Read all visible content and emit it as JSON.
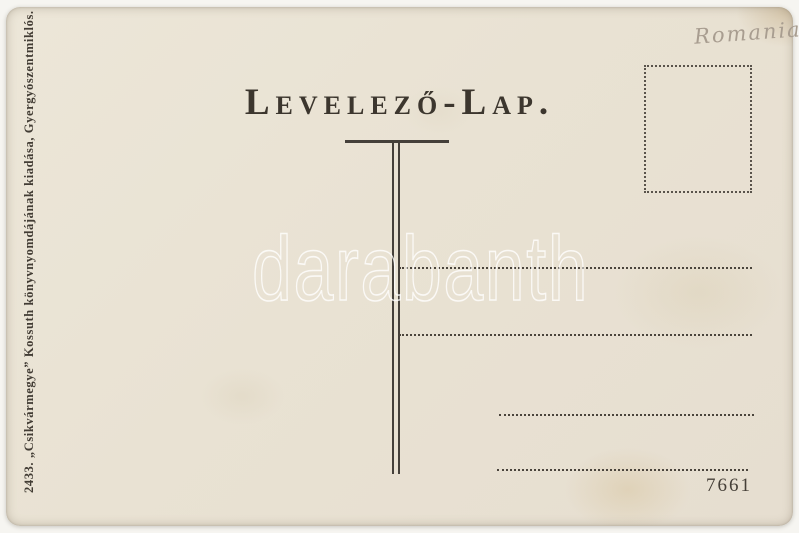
{
  "postcard": {
    "title": "Levelező-Lap.",
    "publisher_imprint": "2433. „Csikvármegye” Kossuth könyvnyomdájának kiadása, Gyergyószentmiklós.",
    "handwritten_note": "Romania",
    "serial_number": "7661",
    "watermark_text": "darabanth"
  },
  "colors": {
    "card_background": "#e9e2d3",
    "printed_ink": "#3e3933",
    "pencil_note": "#a89d90",
    "watermark": "#ffffff"
  }
}
